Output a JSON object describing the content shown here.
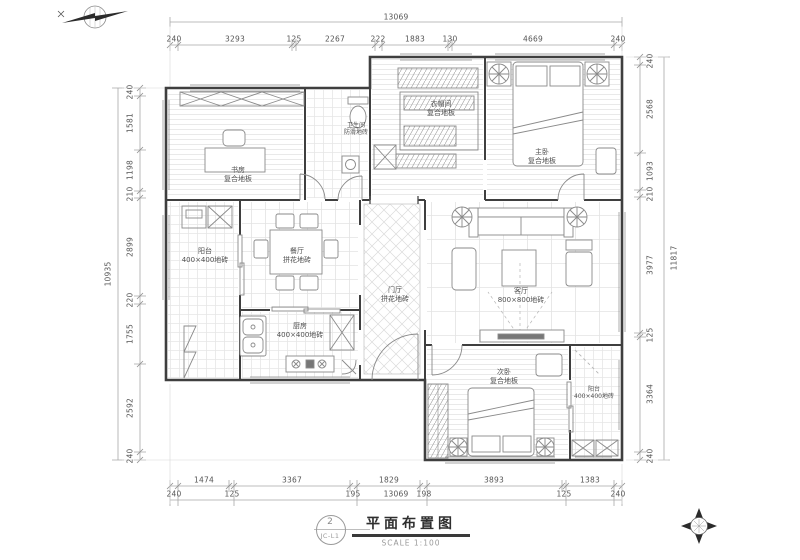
{
  "meta": {
    "title": "平面布置图",
    "scale": "SCALE 1:100",
    "sheet_no": "2",
    "sheet_code": "JC-L1"
  },
  "dims": {
    "top_total": "13069",
    "top": [
      "240",
      "3293",
      "125",
      "2267",
      "222",
      "1883",
      "130",
      "4669",
      "240"
    ],
    "bottom_total": "13069",
    "bottom_inner": [
      "1474",
      "3367",
      "1829",
      "3893",
      "1383"
    ],
    "bottom_outer": [
      "240",
      "125",
      "195",
      "198",
      "125",
      "240"
    ],
    "left_total": "10935",
    "left": [
      "240",
      "1581",
      "1198",
      "210",
      "2899",
      "220",
      "1755",
      "2592",
      "240"
    ],
    "right_total": "11817",
    "right": [
      "240",
      "2568",
      "1093",
      "210",
      "3977",
      "125",
      "3364",
      "240"
    ]
  },
  "rooms": {
    "study": {
      "name": "书房",
      "floor": "复合地板"
    },
    "bath": {
      "name": "卫生间",
      "floor": "防滑地砖"
    },
    "cloak": {
      "name": "衣帽间",
      "floor": "复合地板"
    },
    "master": {
      "name": "主卧",
      "floor": "复合地板"
    },
    "balcony_left": {
      "name": "阳台",
      "floor": "400×400地砖"
    },
    "dining": {
      "name": "餐厅",
      "floor": "拼花地砖"
    },
    "entry": {
      "name": "门厅",
      "floor": "拼花地砖"
    },
    "living": {
      "name": "客厅",
      "floor": "800×800地砖"
    },
    "kitchen": {
      "name": "厨房",
      "floor": "400×400地砖"
    },
    "bedroom2": {
      "name": "次卧",
      "floor": "复合地板"
    },
    "balcony_br": {
      "name": "阳台",
      "floor": "400×400地砖"
    }
  },
  "colors": {
    "wall": "#3f3f3f",
    "dimension": "#8f8f8f",
    "furniture": "#8a8a8a",
    "floor_grid": "#e4e4e4",
    "text": "#4a4a4a"
  }
}
